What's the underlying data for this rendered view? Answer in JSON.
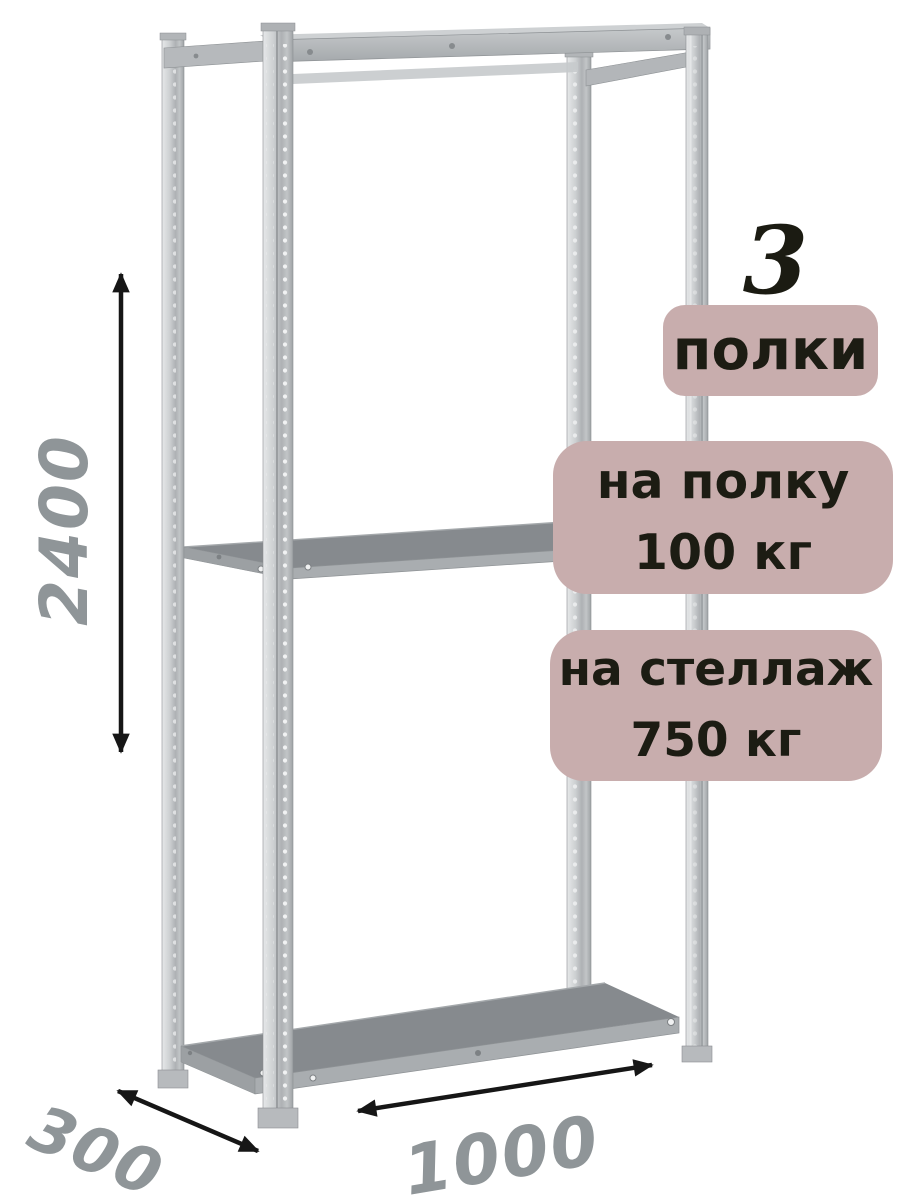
{
  "product_annotations": {
    "shelf_count": "3",
    "shelf_count_label": "полки",
    "shelf_load": {
      "line1": "на полку",
      "line2": "100 кг"
    },
    "rack_load": {
      "line1": "на стеллаж",
      "line2": "750 кг"
    }
  },
  "dimensions": {
    "height": "2400",
    "depth": "300",
    "width": "1000"
  },
  "icons": {
    "rack_illustration": "metal-shelving-rack-with-3-shelves",
    "height_arrow": "vertical-double-headed-arrow",
    "depth_arrow": "diagonal-double-headed-arrow",
    "width_arrow": "horizontal-double-headed-arrow"
  },
  "colors": {
    "background": "#ffffff",
    "badge_background": "#c8adad",
    "badge_text": "#1c1c13",
    "dimension_text": "#8f9598",
    "arrow": "#161616",
    "metal_light": "#dfe1e2",
    "metal_mid": "#b4b7ba",
    "shelf_top": "#868a8e",
    "shelf_face": "#a9adb0"
  }
}
